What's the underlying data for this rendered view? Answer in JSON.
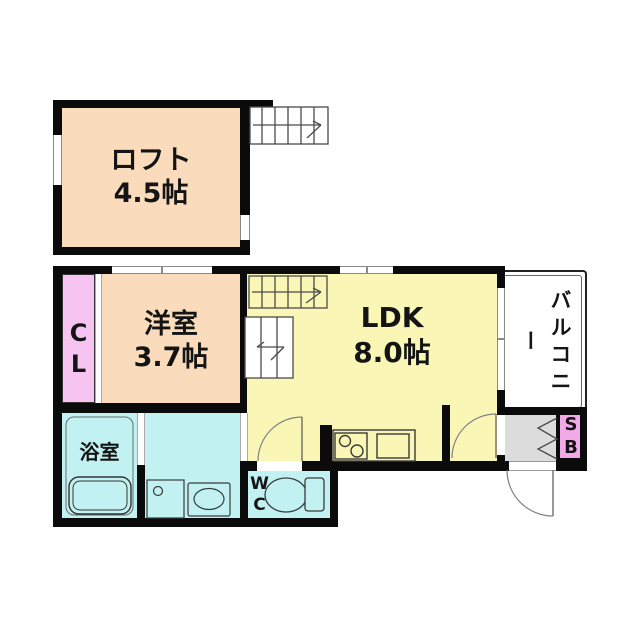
{
  "rooms": {
    "loft": {
      "name": "ロフト",
      "size": "4.5帖"
    },
    "western_room": {
      "name": "洋室",
      "size": "3.7帖"
    },
    "ldk": {
      "name": "LDK",
      "size": "8.0帖"
    },
    "balcony": {
      "name": "バルコニー"
    },
    "closet": {
      "label": "CL"
    },
    "bathroom": {
      "name": "浴室"
    },
    "toilet": {
      "label": "WC"
    },
    "shoe_box": {
      "label": "SB"
    }
  },
  "colors": {
    "wall": "#0b0b0b",
    "loft_and_western_room": "#fadcbd",
    "ldk": "#faf7b6",
    "wet_rooms": "#c2f1f2",
    "closet": "#f7c3f1",
    "shoe_box": "#f2a9e8",
    "entry": "#dcdcdc"
  }
}
